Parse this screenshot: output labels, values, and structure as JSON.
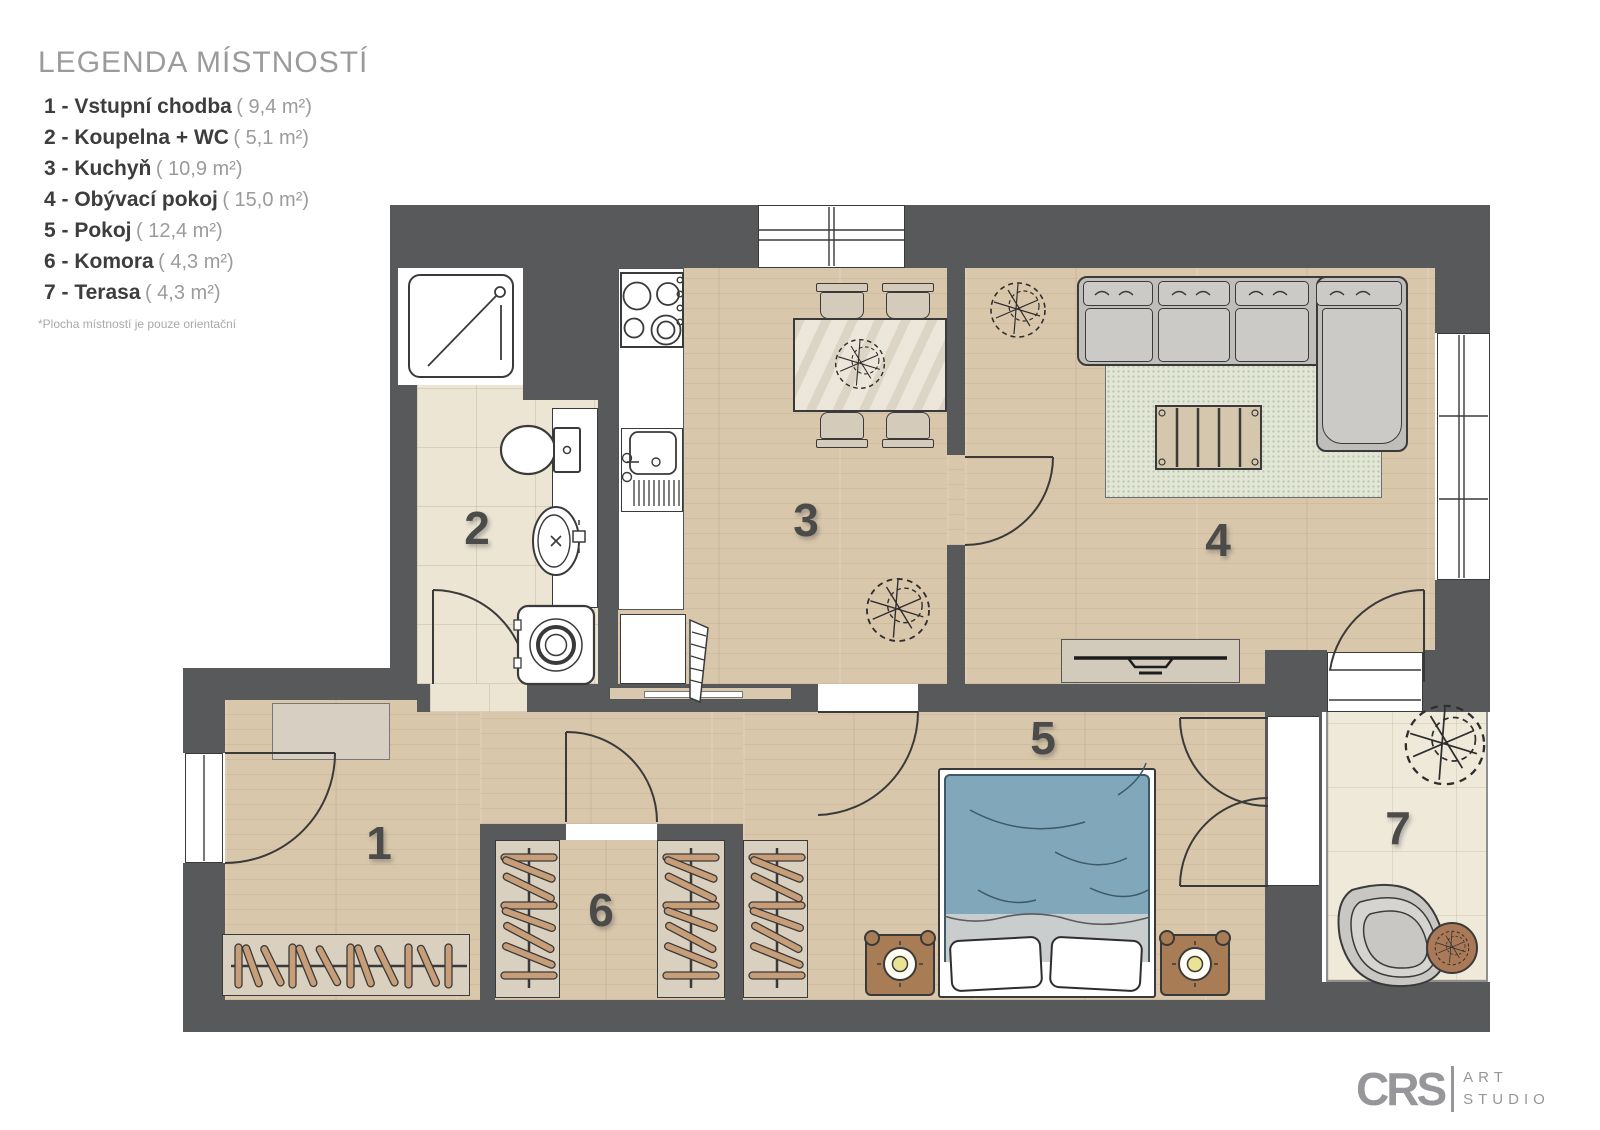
{
  "legend": {
    "title": "LEGENDA MÍSTNOSTÍ",
    "items": [
      {
        "label": "1 - Vstupní chodba",
        "area": "( 9,4 m²)"
      },
      {
        "label": "2 - Koupelna + WC",
        "area": "( 5,1 m²)"
      },
      {
        "label": "3 - Kuchyň",
        "area": "( 10,9 m²)"
      },
      {
        "label": "4 - Obývací pokoj",
        "area": "( 15,0 m²)"
      },
      {
        "label": "5 - Pokoj",
        "area": "( 12,4 m²)"
      },
      {
        "label": "6 - Komora",
        "area": "( 4,3 m²)"
      },
      {
        "label": "7 - Terasa",
        "area": "( 4,3 m²)"
      }
    ],
    "note": "*Plocha místností je pouze orientační"
  },
  "plan": {
    "room_labels": [
      "1",
      "2",
      "3",
      "4",
      "5",
      "6",
      "7"
    ]
  },
  "logo": {
    "abbr": "CRS",
    "line1": "ART",
    "line2": "STUDIO"
  },
  "colors": {
    "wall": "#58595a",
    "wood_floor": "#d9c7ab",
    "bathroom_tile": "#ece5d4",
    "terrace_stone": "#efe9da",
    "rug": "#e1e6d5",
    "bed_blanket": "#80a7ba",
    "furniture_beige": "#d9d0c0",
    "hanger_wood": "#c79e77",
    "nightstand_wood": "#a87c55",
    "outline": "#3a3a3a",
    "legend_gray": "#9b9b9b",
    "legend_dark": "#3d3d3d",
    "room_label": "#4b4b4a"
  }
}
